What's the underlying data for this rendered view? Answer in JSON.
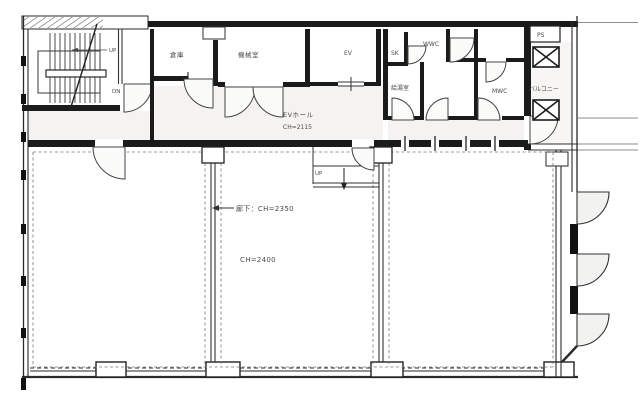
{
  "title": "建物平面図",
  "colors": {
    "wall": "#1b1b1b",
    "line": "#3a3a3a",
    "light_fill": "#f4f3f1",
    "door_fill": "#fbfbfa",
    "text": "#4a4a4a",
    "background": "#ffffff"
  },
  "rooms": {
    "storage": {
      "label": "倉庫"
    },
    "machine_room": {
      "label": "機械室"
    },
    "elevator": {
      "label": "EV"
    },
    "ev_hall": {
      "label": "EVホール",
      "ceiling_height": "CH=2115"
    },
    "sink_closet": {
      "label": "SK"
    },
    "womens_wc": {
      "label": "WWC"
    },
    "kitchenette": {
      "label": "給湯室"
    },
    "mens_wc": {
      "label": "MWC"
    },
    "pipe_shaft": {
      "label": "PS"
    },
    "balcony": {
      "label": "バルコニー"
    }
  },
  "annotations": {
    "corridor_ceiling": "廊下：CH=2350",
    "room_ceiling": "CH=2400",
    "stair_up": "UP",
    "stair_down": "DN",
    "step_up": "UP"
  }
}
